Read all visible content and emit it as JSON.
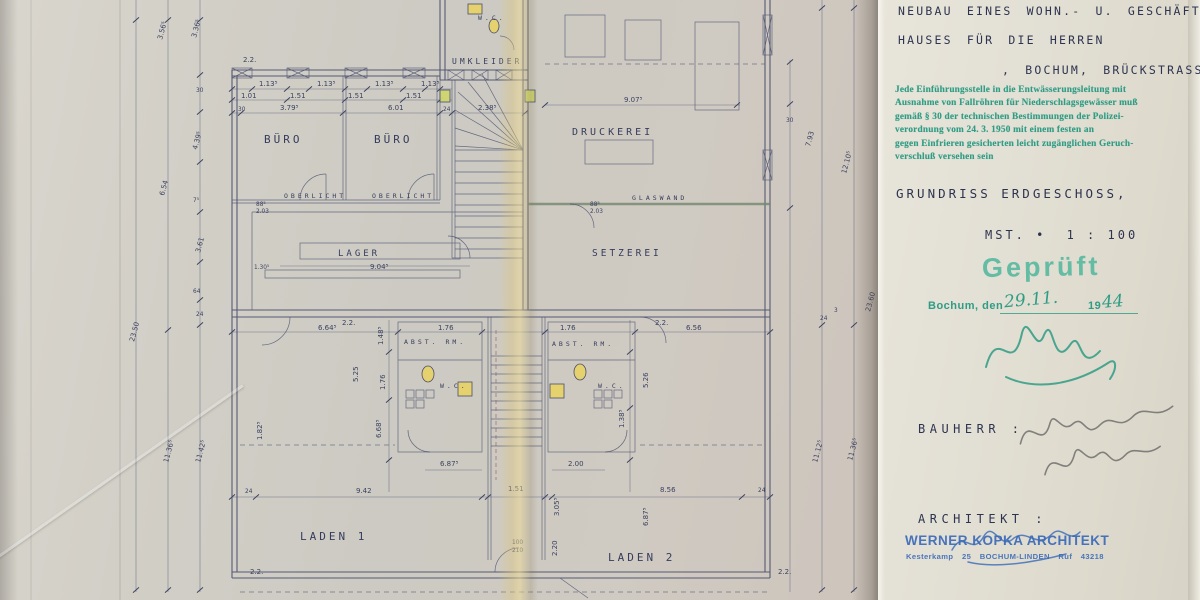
{
  "colors": {
    "ink": "#3a4060",
    "green_stamp": "#2f9c85",
    "green_bright": "#53b89e",
    "blue_stamp": "#3a6ab8",
    "pencil": "#6a6a6a",
    "fixture_yellow": "#e7d36a",
    "pipe_green": "#cfd66e",
    "paper_left": "#cfccc4",
    "paper_flap": "#e2dfd4"
  },
  "title_block": {
    "line1": "NEUBAU EINES WOHN.- U. GESCHÄFTS-",
    "line2": "HAUSES FÜR DIE HERREN",
    "line3": ", BOCHUM, BRÜCKSTRASSE.",
    "regulation_stamp": {
      "line1": "Jede Einführungsstelle in die Entwässerungsleitung mit",
      "line2": "Ausnahme von Fallröhren für Niederschlagsgewässer muß",
      "line3": "gemäß § 30 der technischen Bestimmungen der Polizei-",
      "line4": "verordnung vom 24. 3. 1950 mit einem festen an",
      "line5": "gegen Einfrieren gesicherten leicht zugänglichen Geruch-",
      "line6": "verschluß versehen sein"
    },
    "drawing_title": "GRUNDRISS ERDGESCHOSS,",
    "scale_label": "MST. •",
    "scale_value": "1 : 100",
    "approval_stamp": {
      "stamp_text": "Geprüft",
      "place_line": "Bochum, den",
      "date_hand": "29.11.",
      "year_print": "19",
      "year_hand": "44"
    },
    "bauherr_label": "BAUHERR :",
    "architekt_label": "ARCHITEKT :",
    "architect_stamp": {
      "line1": "WERNER KOPKA ARCHITEKT",
      "line2": "Kesterkamp 25   BOCHUM-LINDEN   Ruf 43218"
    }
  },
  "plan": {
    "rooms": {
      "buero1": "BÜRO",
      "buero2": "BÜRO",
      "druckerei": "DRUCKEREI",
      "setzerei": "SETZEREI",
      "lager": "LAGER",
      "umkleider": "UMKLEIDER",
      "wc_top": "W.C.",
      "wc_left": "W.C.",
      "wc_right": "W.C.",
      "abst_left": "ABST. RM.",
      "abst_right": "ABST. RM.",
      "laden1": "LADEN 1",
      "laden2": "LADEN 2",
      "oberlicht1": "OBERLICHT",
      "oberlicht2": "OBERLICHT",
      "glaswand": "GLASWAND"
    },
    "dims": {
      "v22": "2.2.",
      "v113": "1.13⁵",
      "v101": "1.01",
      "v151": "1.51",
      "v30": "30",
      "v379": "3.79⁵",
      "v601": "6.01",
      "v24": "24",
      "v238": "2.38⁵",
      "v907": "9.07⁵",
      "v904": "9.04⁵",
      "v130": "1.30⁵",
      "v88": "88⁵",
      "v203": "2.03",
      "v664": "6.64⁵",
      "v176": "1.76",
      "v656": "6.56",
      "v148": "1.48⁵",
      "v525": "5.25",
      "v668": "6.68⁵",
      "v182": "1.82⁵",
      "v526": "5.26",
      "v138": "1.38⁵",
      "v200": "2.00",
      "v687": "6.87⁵",
      "v942": "9.42",
      "v856": "8.56",
      "door100": "100",
      "door210": "210",
      "v305": "3.05⁵",
      "v220": "2.20",
      "v793": "7.93",
      "v1210": "12.10⁵",
      "v2360": "23.60",
      "v2350": "23.50",
      "v356": "3.56⁵",
      "v336": "3.36⁵",
      "v439": "4.39⁵",
      "v654": "6.54",
      "v7": "7⁵",
      "v361": "3.61",
      "v64": "64",
      "v1136": "11.36⁵",
      "v1142": "11.42⁵",
      "v1112": "11.12⁵",
      "v3": "3"
    }
  }
}
